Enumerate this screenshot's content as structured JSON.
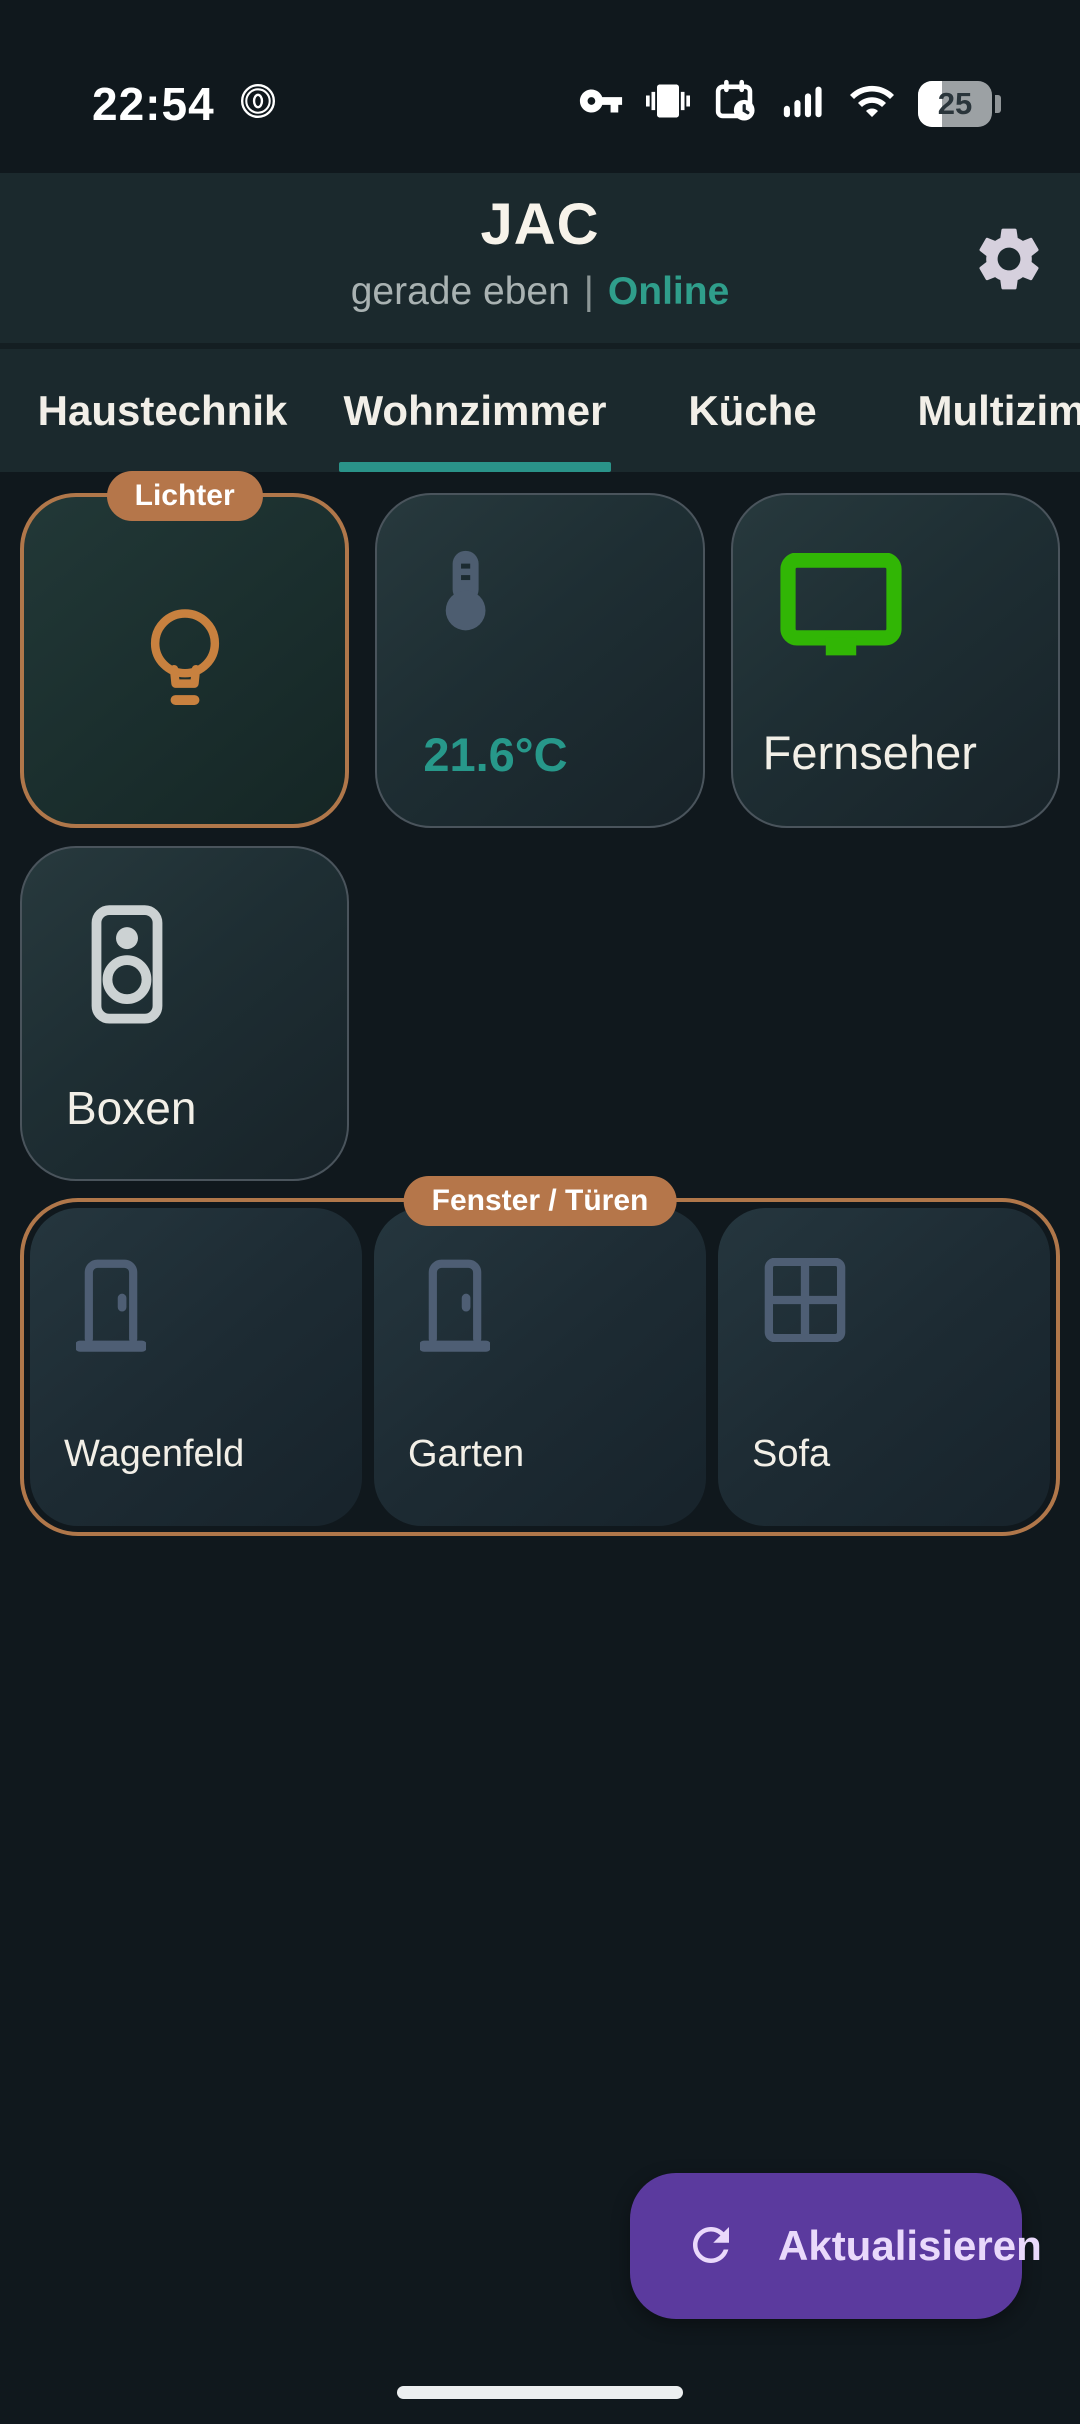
{
  "colors": {
    "accent_teal": "#2a9d8f",
    "copper": "#b5764a",
    "purple": "#5b3a9e",
    "tv_green": "#31b605",
    "slate_icon": "#4e5e74",
    "speaker_icon": "#ccd2d3"
  },
  "status_bar": {
    "time": "22:54",
    "left_icon": "zen-mode-icon",
    "right_icons": [
      "key-icon",
      "vibrate-icon",
      "calendar-clock-icon",
      "signal-icon",
      "wifi-icon"
    ],
    "battery_percent": "25"
  },
  "header": {
    "title": "JAC",
    "last_seen": "gerade eben",
    "separator": "|",
    "online_status": "Online",
    "settings_icon": "gear-icon"
  },
  "tabs": [
    {
      "label": "Haustechnik",
      "active": false
    },
    {
      "label": "Wohnzimmer",
      "active": true
    },
    {
      "label": "Küche",
      "active": false
    },
    {
      "label": "Multizimmer",
      "active": false
    }
  ],
  "content": {
    "lichter_group": {
      "badge": "Lichter",
      "tile": {
        "icon": "lightbulb-icon"
      }
    },
    "temperature_tile": {
      "icon": "thermometer-icon",
      "value": "21.6°C"
    },
    "tv_tile": {
      "icon": "tv-icon",
      "label": "Fernseher"
    },
    "speaker_tile": {
      "icon": "speaker-icon",
      "label": "Boxen"
    },
    "fenster_tueren_group": {
      "badge": "Fenster / Türen",
      "tiles": [
        {
          "icon": "door-icon",
          "label": "Wagenfeld"
        },
        {
          "icon": "door-icon",
          "label": "Garten"
        },
        {
          "icon": "window-icon",
          "label": "Sofa"
        }
      ]
    }
  },
  "refresh_button": {
    "icon": "refresh-icon",
    "label": "Aktualisieren"
  }
}
